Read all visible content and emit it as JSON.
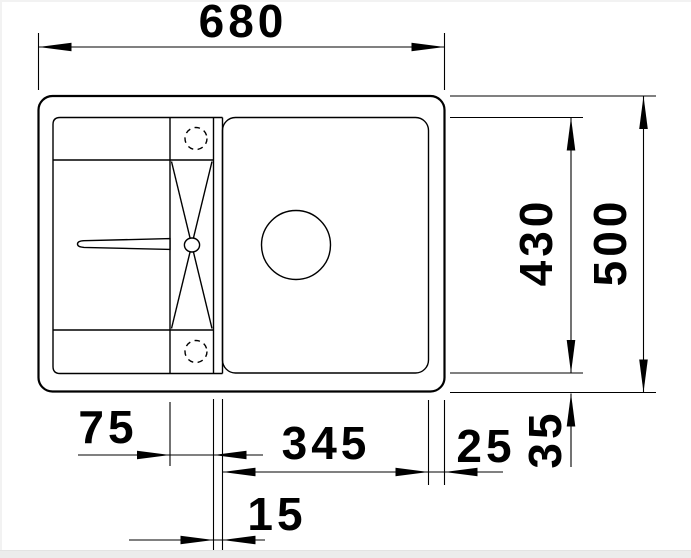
{
  "drawing": {
    "labels": {
      "overall_width": "680",
      "overall_depth": "500",
      "cutout_depth": "430",
      "drainer_width": "75",
      "bowl_width": "345",
      "edge_right": "25",
      "edge_bottom": "35",
      "divider": "15"
    },
    "colors": {
      "line": "#000000",
      "background": "#ffffff",
      "edge_tint": "#ececec"
    }
  }
}
